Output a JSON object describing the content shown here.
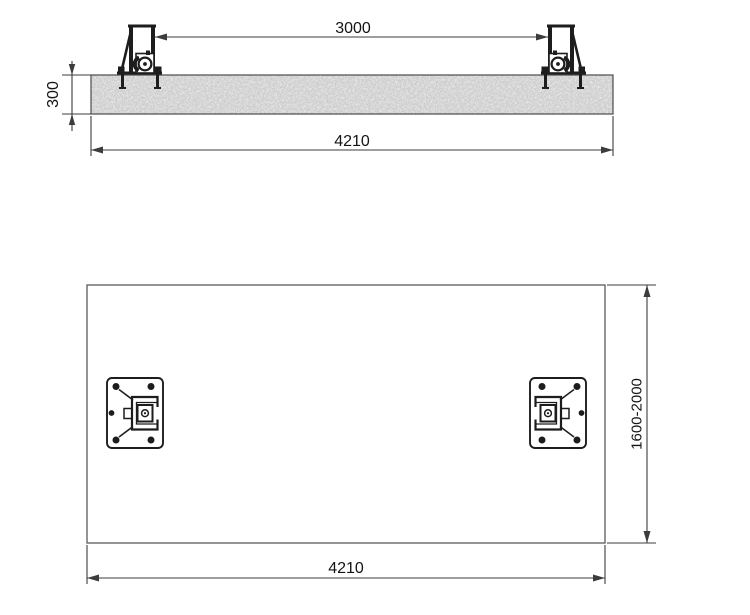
{
  "drawing": {
    "kind": "two-post-lift foundation installation drawing",
    "colors": {
      "background": "#ffffff",
      "line": "#3c3c3c",
      "outline": "#5a5a5a",
      "steel": "#1d1d1d",
      "concrete": "#d5d5d5",
      "text": "#141414"
    },
    "elevation": {
      "dim_post_spacing": "3000",
      "dim_foundation_depth": "300",
      "dim_foundation_length": "4210"
    },
    "plan": {
      "dim_overall_length": "4210",
      "dim_width_range": "1600-2000"
    }
  }
}
